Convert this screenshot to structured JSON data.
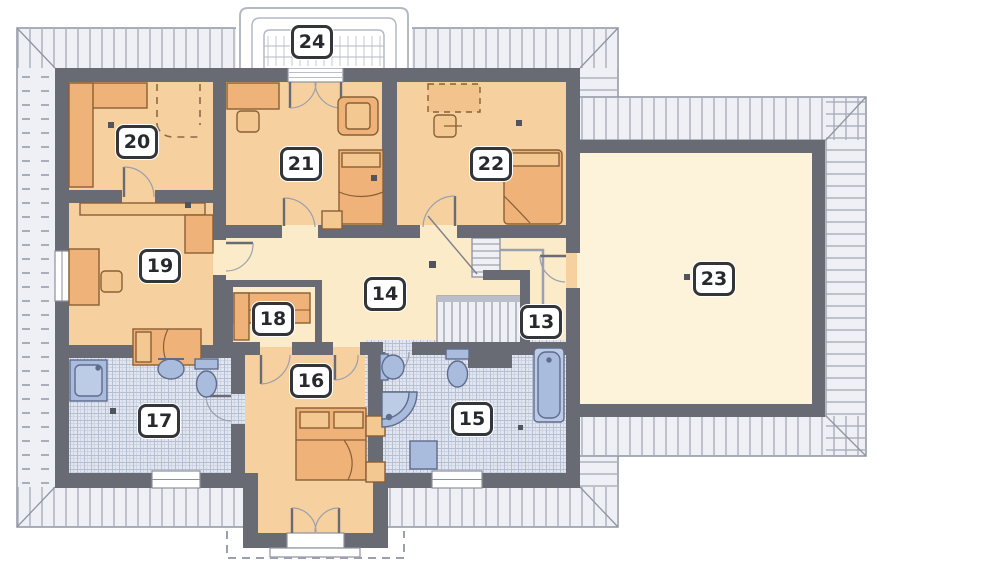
{
  "plan": {
    "type": "attic-floor-plan",
    "rooms": {
      "r13": "13",
      "r14": "14",
      "r15": "15",
      "r16": "16",
      "r17": "17",
      "r18": "18",
      "r19": "19",
      "r20": "20",
      "r21": "21",
      "r22": "22",
      "r23": "23",
      "r24": "24"
    },
    "colors": {
      "wall": "#686b74",
      "roof_fill": "#eef0f5",
      "roof_hatch": "#a9aebb",
      "floor_warm": "#f7d0a0",
      "floor_cream": "#fcebc9",
      "floor_cream_light": "#fdf3da",
      "furniture": "#efb278",
      "furniture_light": "#f4c891",
      "furniture_outline": "#8a5f35",
      "tile_base": "#e2e6f0",
      "tile_line": "#b6bed2",
      "fixture_blue": "#a9bcde",
      "fixture_outline": "#5f6c8c",
      "label_border": "#333539"
    }
  }
}
